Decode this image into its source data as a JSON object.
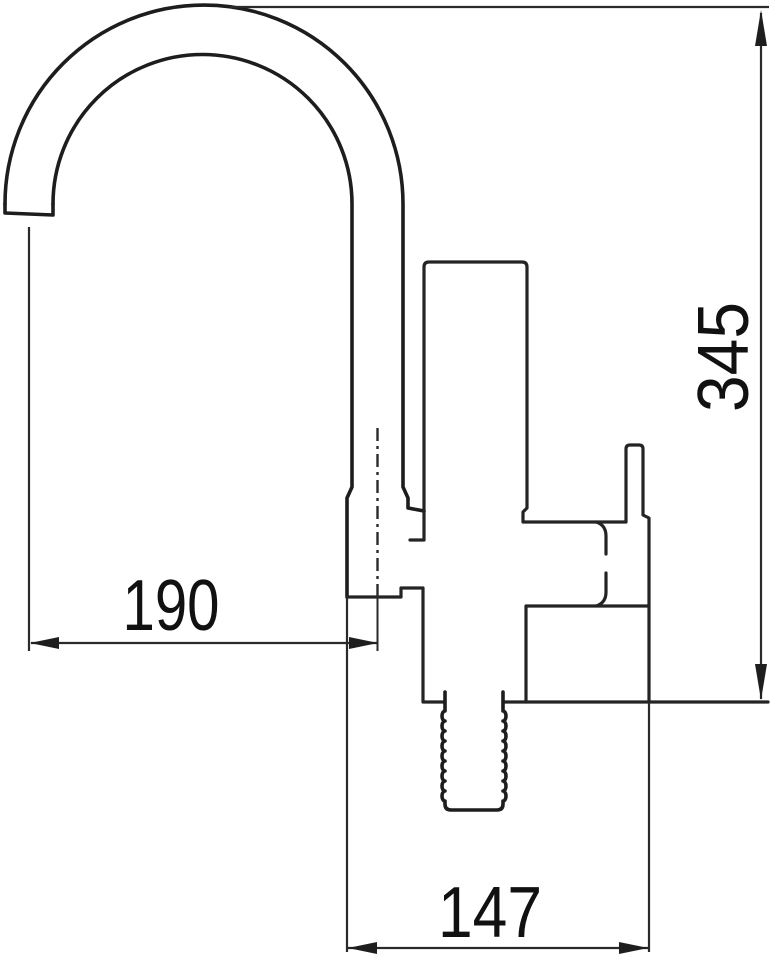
{
  "drawing": {
    "subject": "kitchen-faucet-technical-side-view",
    "style": "black-line-art-on-white",
    "line_color": "#242424",
    "background_color": "#ffffff",
    "parts": [
      "gooseneck-spout-arc",
      "spout-neck",
      "spout-collar",
      "cartridge-body",
      "side-lever-handle",
      "valve-stem",
      "faucet-body-base",
      "threaded-mounting-shank"
    ],
    "dimensions": [
      {
        "id": "spout-reach",
        "label": "190",
        "orientation": "horizontal",
        "position": "middle-left"
      },
      {
        "id": "overall-height",
        "label": "345",
        "orientation": "vertical",
        "position": "right-edge"
      },
      {
        "id": "base-width",
        "label": "147",
        "orientation": "horizontal",
        "position": "bottom"
      }
    ]
  }
}
